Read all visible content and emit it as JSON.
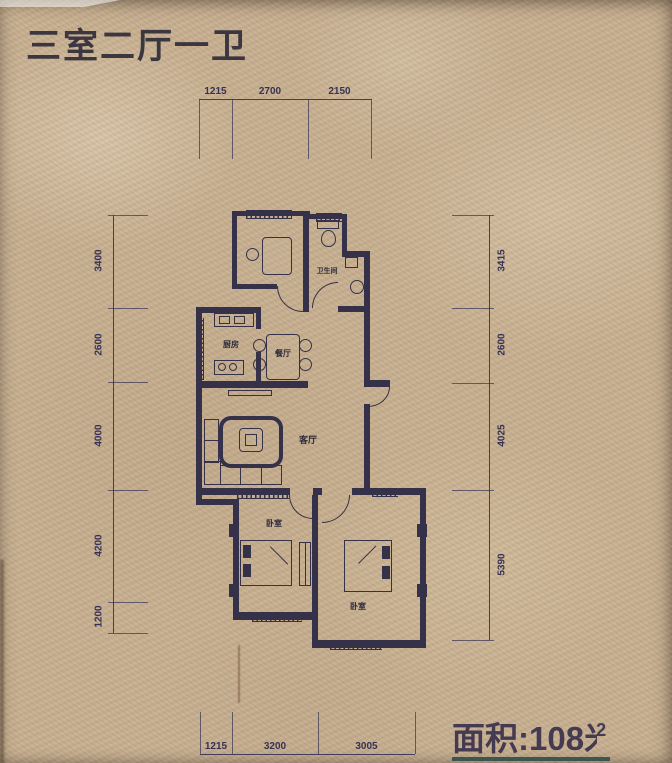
{
  "title": "三室二厅一卫",
  "area": {
    "prefix": "面积:108",
    "unit": "米",
    "superscript": "2"
  },
  "dims": {
    "top": [
      "1215",
      "2700",
      "2150"
    ],
    "bottom": [
      "1215",
      "3200",
      "3005"
    ],
    "left": [
      "3400",
      "2600",
      "4000",
      "4200",
      "1200"
    ],
    "right": [
      "3415",
      "2600",
      "4025",
      "5390"
    ]
  },
  "rooms": {
    "bathroom": "卫生间",
    "kitchen": "厨房",
    "dining": "餐厅",
    "living": "客厅",
    "bedroom_left": "卧室",
    "bedroom_right": "卧室"
  },
  "colors": {
    "background": "#c6ae8e",
    "line": "#353149",
    "title_text": "#3b3640",
    "accent_strip": "#2a4a48"
  }
}
